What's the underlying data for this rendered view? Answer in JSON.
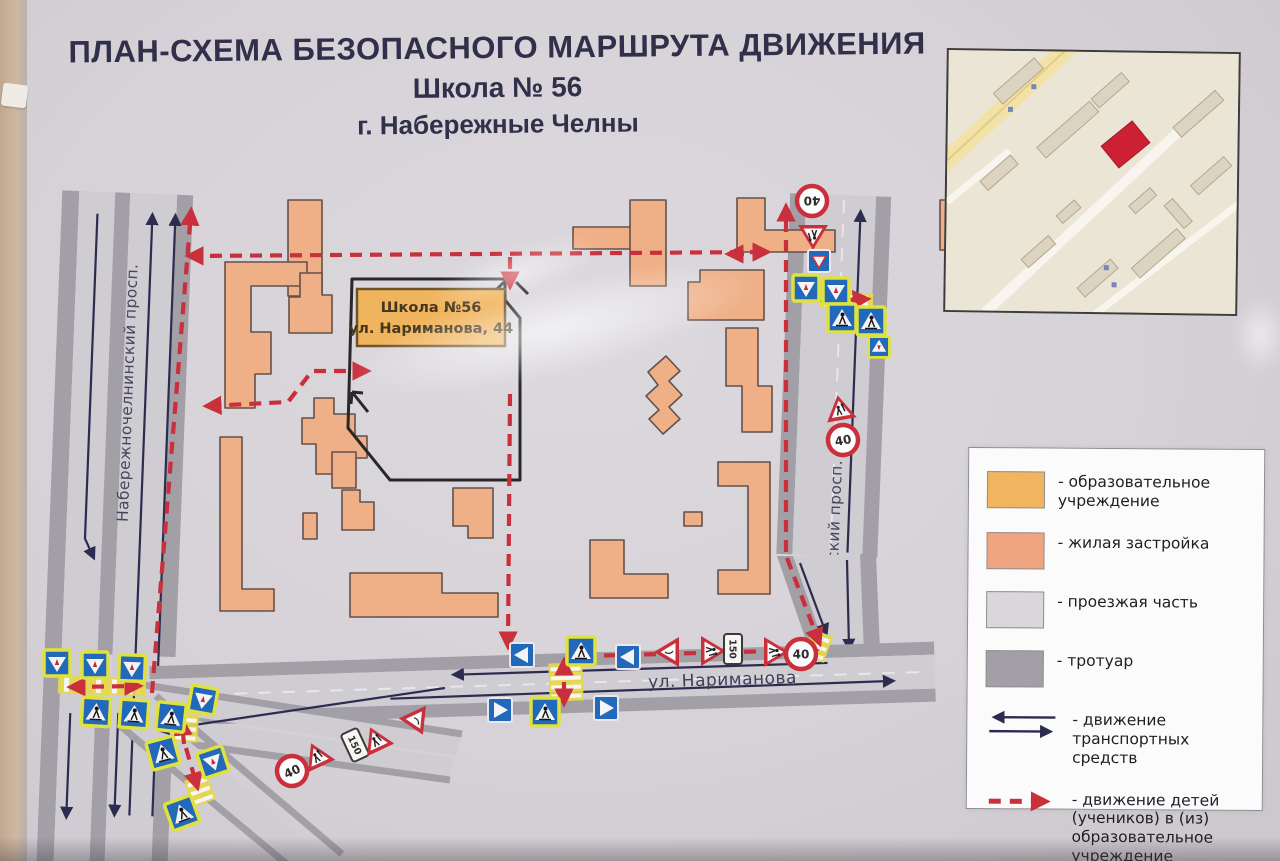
{
  "poster": {
    "title_line1": "ПЛАН-СХЕМА БЕЗОПАСНОГО МАРШРУТА ДВИЖЕНИЯ",
    "title_line2": "Школа № 56",
    "title_line3": "г. Набережные Челны"
  },
  "school": {
    "label_line1": "Школа №56",
    "label_line2": "ул. Нариманова, 44"
  },
  "streets": {
    "left": "Набережночелнинский просп.",
    "right": "Московский просп.",
    "bottom": "ул. Нариманова"
  },
  "legend": {
    "items": [
      {
        "swatch": "edu",
        "label": "- образовательное\nучреждение"
      },
      {
        "swatch": "res",
        "label": "- жилая застройка"
      },
      {
        "swatch": "road",
        "label": "- проезжая часть"
      },
      {
        "swatch": "side",
        "label": "- тротуар"
      },
      {
        "swatch": "traffic-arrows",
        "label": "- движение\nтранспортных средств"
      },
      {
        "swatch": "route-arrow",
        "label": "- движение детей\n(учеников) в (из)\nобразовательное\nучреждение"
      }
    ]
  },
  "colors": {
    "route_red": "#c9303c",
    "traffic_navy": "#2c2b50",
    "education": "#f1b45f",
    "residential": "#efa57f",
    "roadway": "#d9d7dc",
    "sidewalk": "#a2a0a6",
    "sign_blue": "#2268bb",
    "sign_fluor_border": "#dfe23d",
    "inset_highlight": "#cb2133"
  },
  "map": {
    "signs": [
      {
        "t": "cwa",
        "x": 57,
        "y": 663,
        "r": 0
      },
      {
        "t": "cwa",
        "x": 95,
        "y": 665,
        "r": 0
      },
      {
        "t": "cwa",
        "x": 132,
        "y": 668,
        "r": 2
      },
      {
        "t": "cw",
        "x": 96,
        "y": 712,
        "r": 3
      },
      {
        "t": "cw",
        "x": 134,
        "y": 714,
        "r": 4
      },
      {
        "t": "cw",
        "x": 171,
        "y": 717,
        "r": 6
      },
      {
        "t": "cwa",
        "x": 203,
        "y": 700,
        "r": 10
      },
      {
        "t": "cw",
        "x": 163,
        "y": 753,
        "r": -15
      },
      {
        "t": "cwa",
        "x": 213,
        "y": 762,
        "r": -18
      },
      {
        "t": "cw",
        "x": 182,
        "y": 813,
        "r": -20
      },
      {
        "t": "ow",
        "x": 522,
        "y": 655,
        "r": 0
      },
      {
        "t": "cw",
        "x": 581,
        "y": 651,
        "r": 0
      },
      {
        "t": "ow",
        "x": 628,
        "y": 657,
        "r": 0
      },
      {
        "t": "ow",
        "x": 500,
        "y": 710,
        "r": 180
      },
      {
        "t": "cw",
        "x": 545,
        "y": 712,
        "r": 0
      },
      {
        "t": "ow",
        "x": 606,
        "y": 708,
        "r": 180
      },
      {
        "t": "s40",
        "x": 292,
        "y": 771,
        "r": -25,
        "label": "40"
      },
      {
        "t": "ch",
        "x": 317,
        "y": 756,
        "r": -25
      },
      {
        "t": "d150",
        "x": 355,
        "y": 745,
        "r": -25,
        "label": "150"
      },
      {
        "t": "ch",
        "x": 376,
        "y": 740,
        "r": -25
      },
      {
        "t": "gw",
        "x": 417,
        "y": 722,
        "r": -25
      },
      {
        "t": "gw",
        "x": 668,
        "y": 652,
        "r": 90
      },
      {
        "t": "ch",
        "x": 712,
        "y": 651,
        "r": 90
      },
      {
        "t": "d150",
        "x": 733,
        "y": 649,
        "r": 0,
        "label": "150"
      },
      {
        "t": "ch",
        "x": 775,
        "y": 652,
        "r": 90
      },
      {
        "t": "s40",
        "x": 801,
        "y": 654,
        "r": 0,
        "label": "40"
      },
      {
        "t": "s40",
        "x": 812,
        "y": 201,
        "r": 180,
        "label": "40"
      },
      {
        "t": "ch",
        "x": 813,
        "y": 236,
        "r": 180
      },
      {
        "t": "gwb",
        "x": 819,
        "y": 261,
        "r": 0
      },
      {
        "t": "cwa",
        "x": 806,
        "y": 288,
        "r": 0
      },
      {
        "t": "cwa",
        "x": 836,
        "y": 291,
        "r": 0
      },
      {
        "t": "cw",
        "x": 842,
        "y": 318,
        "r": 0
      },
      {
        "t": "cw",
        "x": 871,
        "y": 321,
        "r": 0
      },
      {
        "t": "cwa",
        "x": 879,
        "y": 347,
        "r": 180,
        "sc": 0.8
      },
      {
        "t": "ch",
        "x": 840,
        "y": 409,
        "r": -10
      },
      {
        "t": "s40",
        "x": 843,
        "y": 440,
        "r": -10,
        "label": "40"
      }
    ]
  }
}
